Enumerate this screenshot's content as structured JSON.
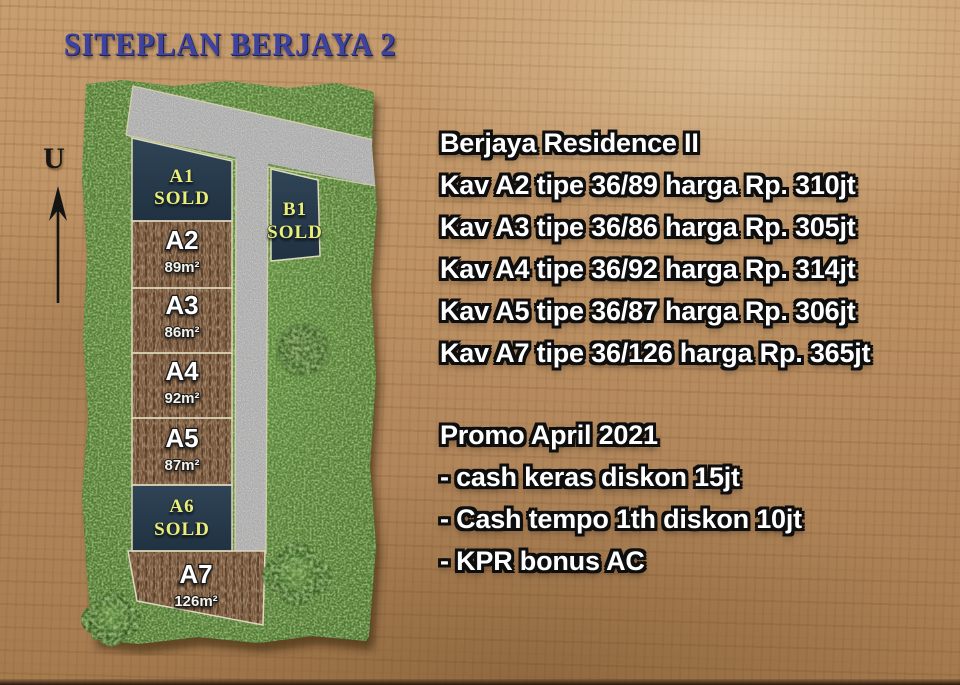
{
  "title": "SITEPLAN BERJAYA 2",
  "north_label": "U",
  "siteplan": {
    "lots": [
      {
        "id": "A1",
        "status": "SOLD"
      },
      {
        "id": "A2",
        "area": "89m²"
      },
      {
        "id": "A3",
        "area": "86m²"
      },
      {
        "id": "A4",
        "area": "92m²"
      },
      {
        "id": "A5",
        "area": "87m²"
      },
      {
        "id": "A6",
        "status": "SOLD"
      },
      {
        "id": "A7",
        "area": "126m²"
      },
      {
        "id": "B1",
        "status": "SOLD"
      }
    ],
    "colors": {
      "title": "#3f43a0",
      "grass": "#567f37",
      "road": "#a9a9a9",
      "dirt": "#6f4c33",
      "sold_lot_fill": "#263a4c",
      "sold_label": "#e9ee78"
    }
  },
  "info": {
    "heading": "Berjaya Residence II",
    "listings": [
      "Kav A2 tipe 36/89 harga Rp. 310jt",
      "Kav A3 tipe 36/86 harga Rp. 305jt",
      "Kav A4 tipe 36/92 harga Rp. 314jt",
      "Kav A5 tipe 36/87 harga Rp. 306jt",
      "Kav A7 tipe 36/126 harga Rp. 365jt"
    ],
    "promo": {
      "heading": "Promo April 2021",
      "items": [
        "- cash keras diskon 15jt",
        "- Cash tempo 1th diskon 10jt",
        "- KPR bonus AC"
      ]
    }
  }
}
